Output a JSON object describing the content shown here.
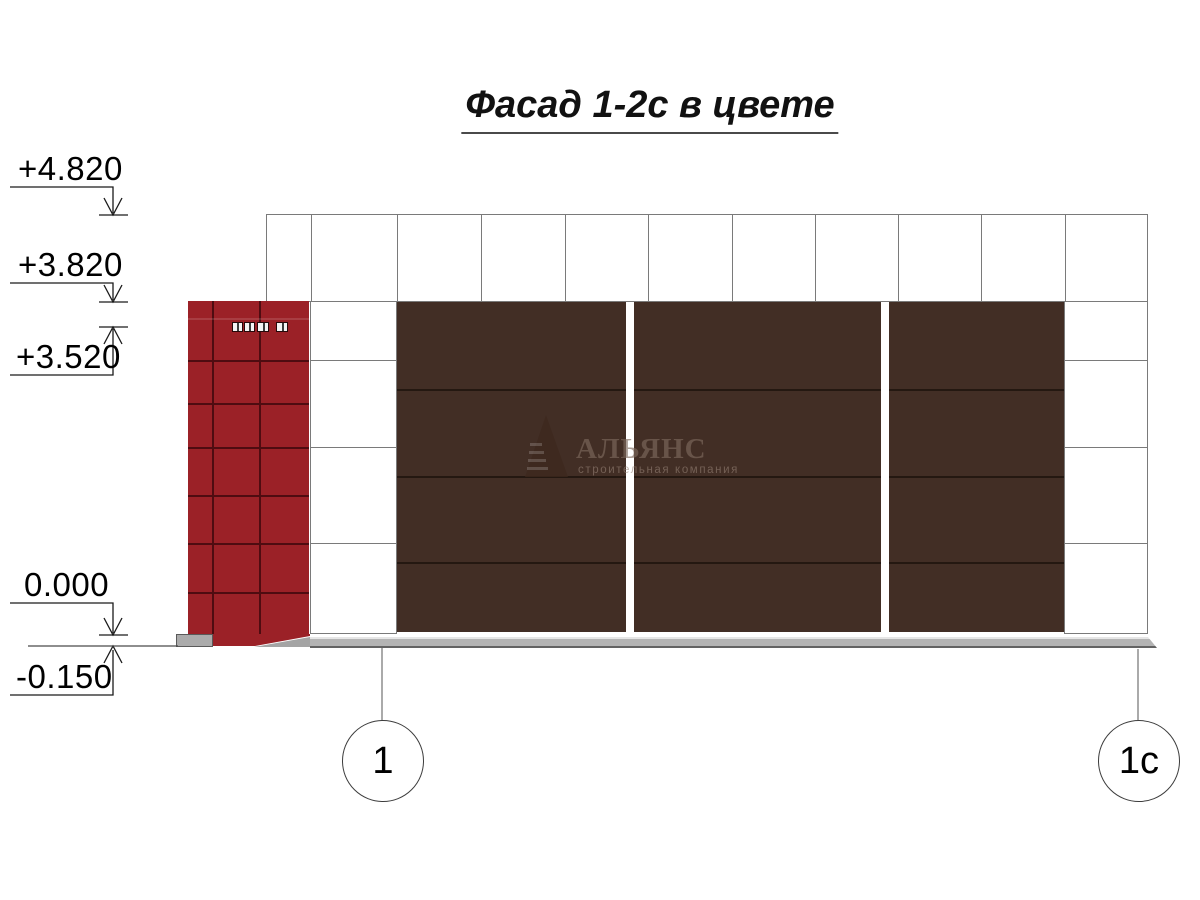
{
  "title": "Фасад 1-2с в цвете",
  "elevation_marks": [
    {
      "label": "+4.820"
    },
    {
      "label": "+3.820"
    },
    {
      "label": "+3.520"
    },
    {
      "label": "0.000"
    },
    {
      "label": "-0.150"
    }
  ],
  "axis_markers": [
    {
      "label": "1"
    },
    {
      "label": "1с"
    }
  ],
  "watermark": {
    "name": "АЛЬЯНС",
    "tagline": "строительная компания"
  },
  "facade": {
    "red_tower_color": "#9b2127",
    "brown_panel_color": "#422e25",
    "wall_grid_color": "#7a7a7a",
    "base_color": "#b2b2b2",
    "brown_panel_count": 3,
    "vent_count": 4
  }
}
